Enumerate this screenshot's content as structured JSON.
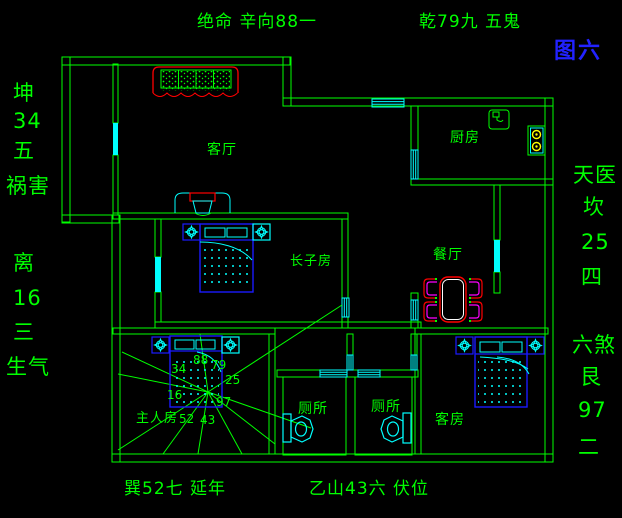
{
  "annotations": {
    "top": "绝命 辛向88一",
    "top_right": "乾79九 五鬼",
    "figure_label": "图六",
    "left_upper": [
      "坤",
      "34",
      "五",
      "祸害"
    ],
    "left_lower": [
      "离",
      "16",
      "三",
      "生气"
    ],
    "right_upper": [
      "天医",
      "坎",
      "25",
      "四"
    ],
    "right_lower": [
      "六煞",
      "艮",
      "97",
      "二"
    ],
    "bottom_left": "巽52七 延年",
    "bottom_right": "乙山43六 伏位"
  },
  "room_labels": {
    "living": "客厅",
    "kitchen": "厨房",
    "dining": "餐厅",
    "eldest_son": "长子房",
    "master": "主人房",
    "toilet_left": "厕所",
    "toilet_right": "厕所",
    "guest": "客房"
  },
  "star_numbers": [
    "88",
    "79",
    "34",
    "25",
    "16",
    "97",
    "52",
    "43"
  ],
  "colors": {
    "background": "#000000",
    "wall_green": "#00ff00",
    "fixture_cyan": "#00ffff",
    "furniture_blue": "#1a1aff",
    "accent_red": "#ff0000",
    "accent_magenta": "#ff00ff",
    "burner_yellow": "#ffff00",
    "table_inner_white": "#ffffff",
    "figure_label_blue": "#2222ff"
  }
}
